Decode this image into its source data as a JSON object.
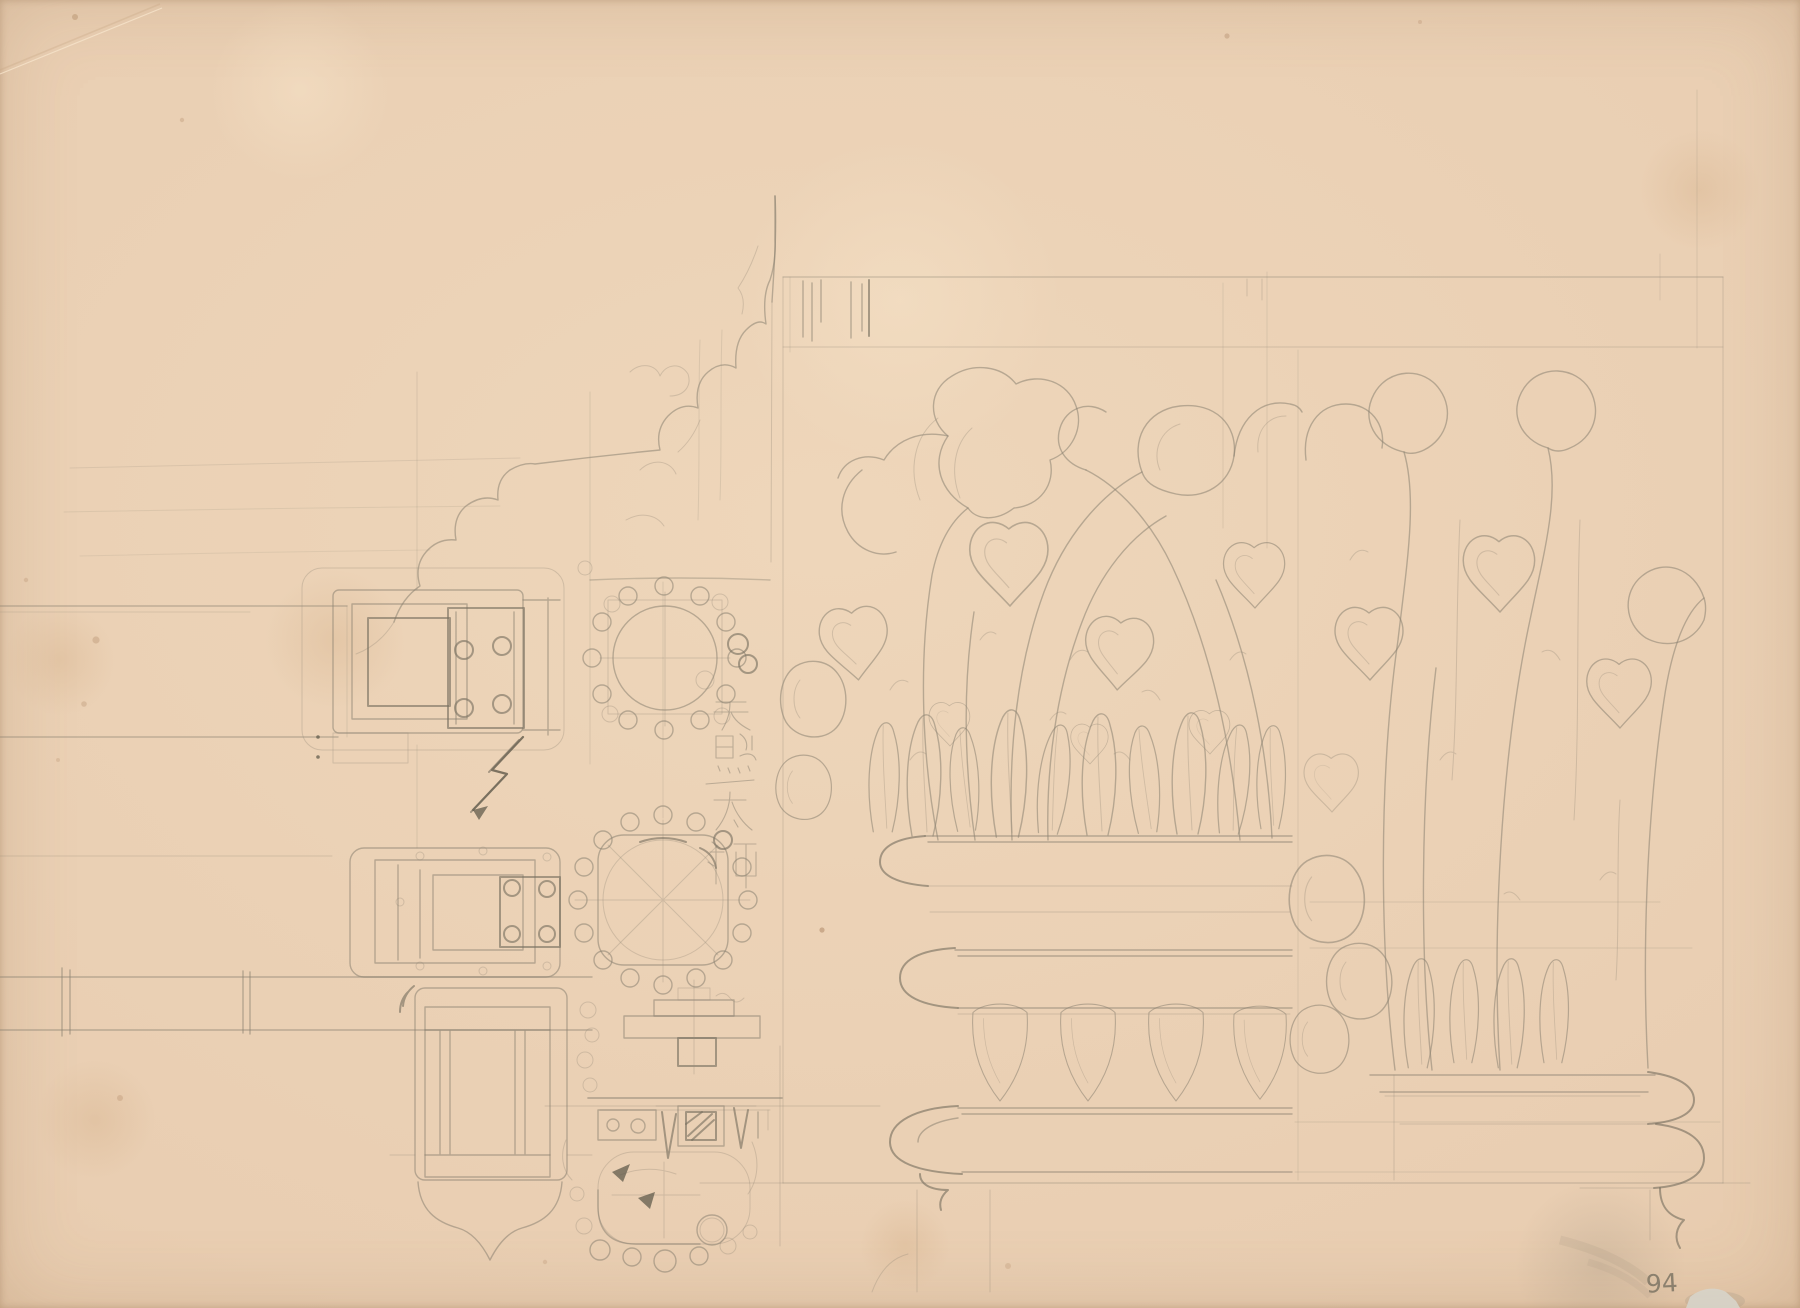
{
  "sheet": {
    "annotations": {
      "inscription_vertical": "天照太神",
      "sheet_number": "94"
    },
    "palette": {
      "paper": "#e9ceb2",
      "paper_edge": "#d8b592",
      "pencil": "#8a8171",
      "pencil_dark": "#5d5748",
      "smudge_gray": "#a2947f",
      "patch_white": "#d7d3c7"
    },
    "elements": [
      "construction-frame",
      "ogee-arch-profile-sketch",
      "entablature-band-upper-left",
      "beam-band-lower-left",
      "bracket-fitting-top",
      "bracket-fitting-middle",
      "bracket-fitting-bottom",
      "pendant-bracket-profile",
      "rosette-plan",
      "column-plan-square",
      "stepped-section-detail",
      "channel-section-detail",
      "column-plan-partial",
      "direction-arrow-sketch",
      "capital-elevation-main",
      "capital-elevation-right",
      "inscription-kanji",
      "sheet-number"
    ]
  }
}
